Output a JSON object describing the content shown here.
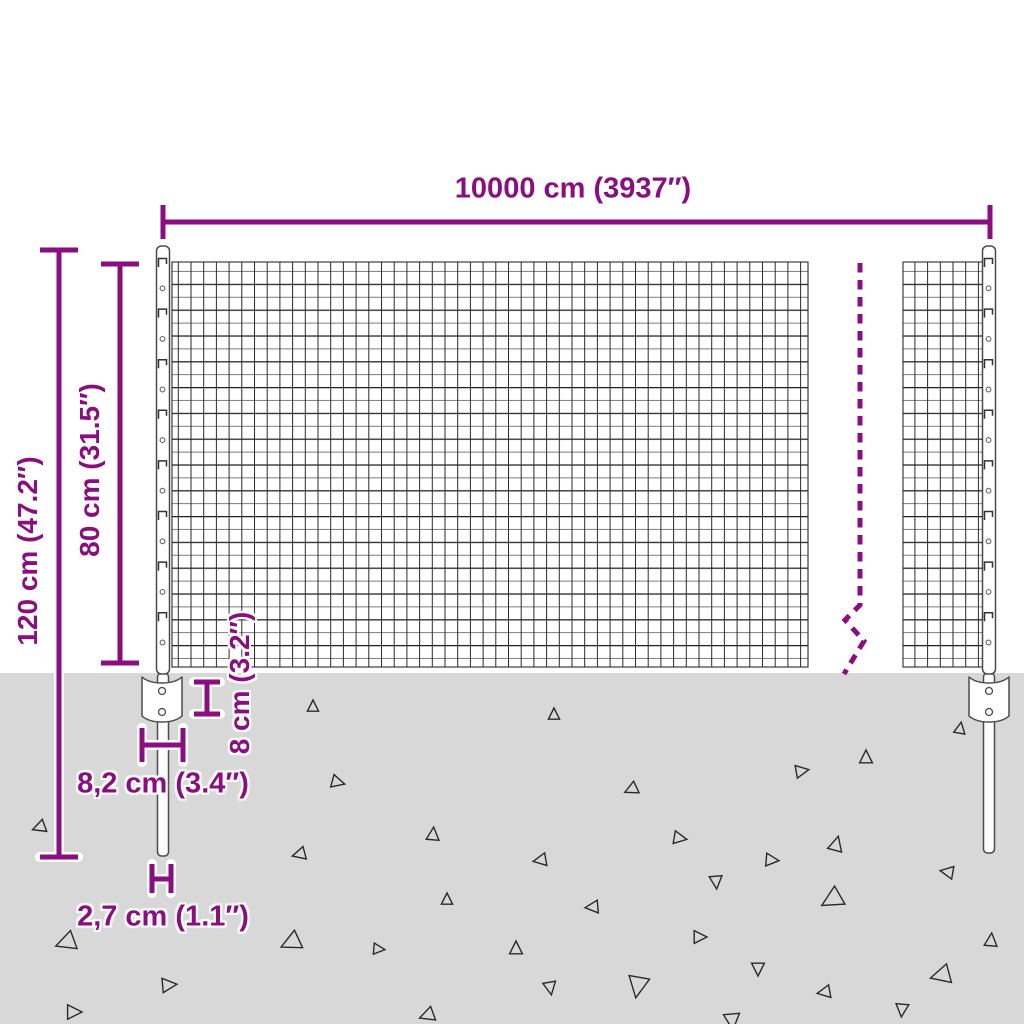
{
  "colors": {
    "accent": "#8A0E7F",
    "ground": "#D8D8D8",
    "mesh_line": "#2A2A2A",
    "post_outline": "#4A4A4A",
    "triangle_outline": "#2A2A2A"
  },
  "labels": {
    "width": "10000 cm (3937″)",
    "total_height": "120 cm (47.2″)",
    "mesh_height": "80 cm (31.5″)",
    "anchor_height": "8 cm (3.2″)",
    "anchor_width": "8,2 cm (3.4″)",
    "post_diameter": "2,7 cm (1.1″)"
  },
  "ground": {
    "triangles": [
      {
        "x": 313,
        "y": 707,
        "s": 7,
        "r": 0
      },
      {
        "x": 554,
        "y": 715,
        "s": 7,
        "r": 0
      },
      {
        "x": 960,
        "y": 729,
        "s": 7,
        "r": 10
      },
      {
        "x": 40,
        "y": 827,
        "s": 8,
        "r": 250
      },
      {
        "x": 337,
        "y": 782,
        "s": 8,
        "r": 105
      },
      {
        "x": 300,
        "y": 854,
        "s": 8,
        "r": 255
      },
      {
        "x": 433,
        "y": 835,
        "s": 8,
        "r": 5
      },
      {
        "x": 447,
        "y": 900,
        "s": 7,
        "r": 0
      },
      {
        "x": 866,
        "y": 758,
        "s": 8,
        "r": 0
      },
      {
        "x": 801,
        "y": 771,
        "s": 8,
        "r": 80
      },
      {
        "x": 632,
        "y": 789,
        "s": 8,
        "r": 245
      },
      {
        "x": 679,
        "y": 838,
        "s": 8,
        "r": 100
      },
      {
        "x": 541,
        "y": 860,
        "s": 8,
        "r": 260
      },
      {
        "x": 771,
        "y": 860,
        "s": 8,
        "r": 95
      },
      {
        "x": 836,
        "y": 845,
        "s": 9,
        "r": 15
      },
      {
        "x": 716,
        "y": 881,
        "s": 8,
        "r": 175
      },
      {
        "x": 593,
        "y": 907,
        "s": 8,
        "r": 265
      },
      {
        "x": 948,
        "y": 872,
        "s": 8,
        "r": 280
      },
      {
        "x": 833,
        "y": 899,
        "s": 13,
        "r": 240
      },
      {
        "x": 699,
        "y": 937,
        "s": 8,
        "r": 90
      },
      {
        "x": 516,
        "y": 949,
        "s": 8,
        "r": 0
      },
      {
        "x": 292,
        "y": 942,
        "s": 12,
        "r": 245
      },
      {
        "x": 378,
        "y": 949,
        "s": 7,
        "r": 95
      },
      {
        "x": 67,
        "y": 942,
        "s": 12,
        "r": 250
      },
      {
        "x": 758,
        "y": 968,
        "s": 8,
        "r": 180
      },
      {
        "x": 550,
        "y": 987,
        "s": 8,
        "r": 170
      },
      {
        "x": 638,
        "y": 985,
        "s": 13,
        "r": 190
      },
      {
        "x": 825,
        "y": 992,
        "s": 8,
        "r": 260
      },
      {
        "x": 942,
        "y": 975,
        "s": 12,
        "r": 255
      },
      {
        "x": 991,
        "y": 941,
        "s": 8,
        "r": 5
      },
      {
        "x": 902,
        "y": 1009,
        "s": 8,
        "r": 185
      },
      {
        "x": 732,
        "y": 1020,
        "s": 10,
        "r": 175
      },
      {
        "x": 168,
        "y": 985,
        "s": 9,
        "r": 85
      },
      {
        "x": 73,
        "y": 1012,
        "s": 9,
        "r": 90
      },
      {
        "x": 428,
        "y": 1015,
        "s": 9,
        "r": 250
      }
    ]
  }
}
